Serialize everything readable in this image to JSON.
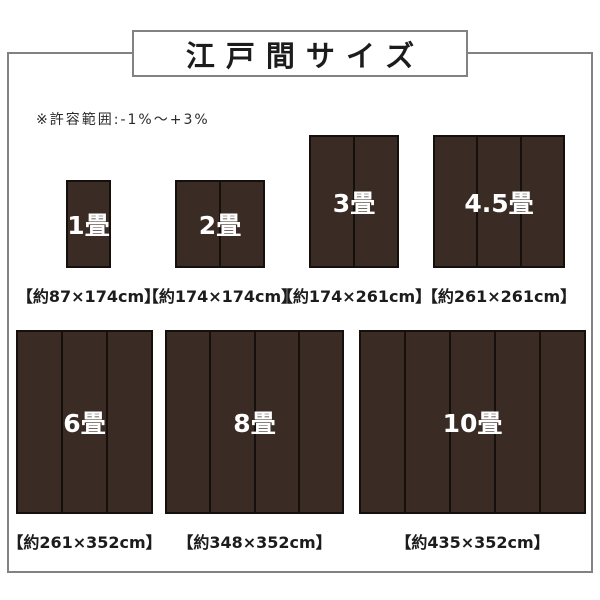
{
  "title": "江戸間サイズ",
  "note": "※許容範囲:-1%〜+3%",
  "colors": {
    "background": "#ffffff",
    "frame_border": "#828282",
    "mat_fill": "#3a2c25",
    "mat_border": "#16100c",
    "mat_divider": "#16100c",
    "mat_label_text": "#ffffff",
    "text": "#1c1c1c"
  },
  "mats": [
    {
      "key": "1jo",
      "name": "1畳",
      "dimensions": "【約87×174cm】",
      "width_cm": 87,
      "height_cm": 174,
      "panels": 1,
      "px": {
        "x": 66,
        "y": 180,
        "w": 45,
        "h": 88
      }
    },
    {
      "key": "2jo",
      "name": "2畳",
      "dimensions": "【約174×174cm】",
      "width_cm": 174,
      "height_cm": 174,
      "panels": 2,
      "px": {
        "x": 175,
        "y": 180,
        "w": 90,
        "h": 88
      }
    },
    {
      "key": "3jo",
      "name": "3畳",
      "dimensions": "【約174×261cm】",
      "width_cm": 174,
      "height_cm": 261,
      "panels": 2,
      "px": {
        "x": 309,
        "y": 135,
        "w": 90,
        "h": 133
      }
    },
    {
      "key": "4_5jo",
      "name": "4.5畳",
      "dimensions": "【約261×261cm】",
      "width_cm": 261,
      "height_cm": 261,
      "panels": 3,
      "px": {
        "x": 433,
        "y": 135,
        "w": 132,
        "h": 133
      }
    },
    {
      "key": "6jo",
      "name": "6畳",
      "dimensions": "【約261×352cm】",
      "width_cm": 261,
      "height_cm": 352,
      "panels": 3,
      "px": {
        "x": 16,
        "y": 330,
        "w": 137,
        "h": 184
      }
    },
    {
      "key": "8jo",
      "name": "8畳",
      "dimensions": "【約348×352cm】",
      "width_cm": 348,
      "height_cm": 352,
      "panels": 4,
      "px": {
        "x": 165,
        "y": 330,
        "w": 179,
        "h": 184
      }
    },
    {
      "key": "10jo",
      "name": "10畳",
      "dimensions": "【約435×352cm】",
      "width_cm": 435,
      "height_cm": 352,
      "panels": 5,
      "px": {
        "x": 359,
        "y": 330,
        "w": 227,
        "h": 184
      }
    }
  ]
}
